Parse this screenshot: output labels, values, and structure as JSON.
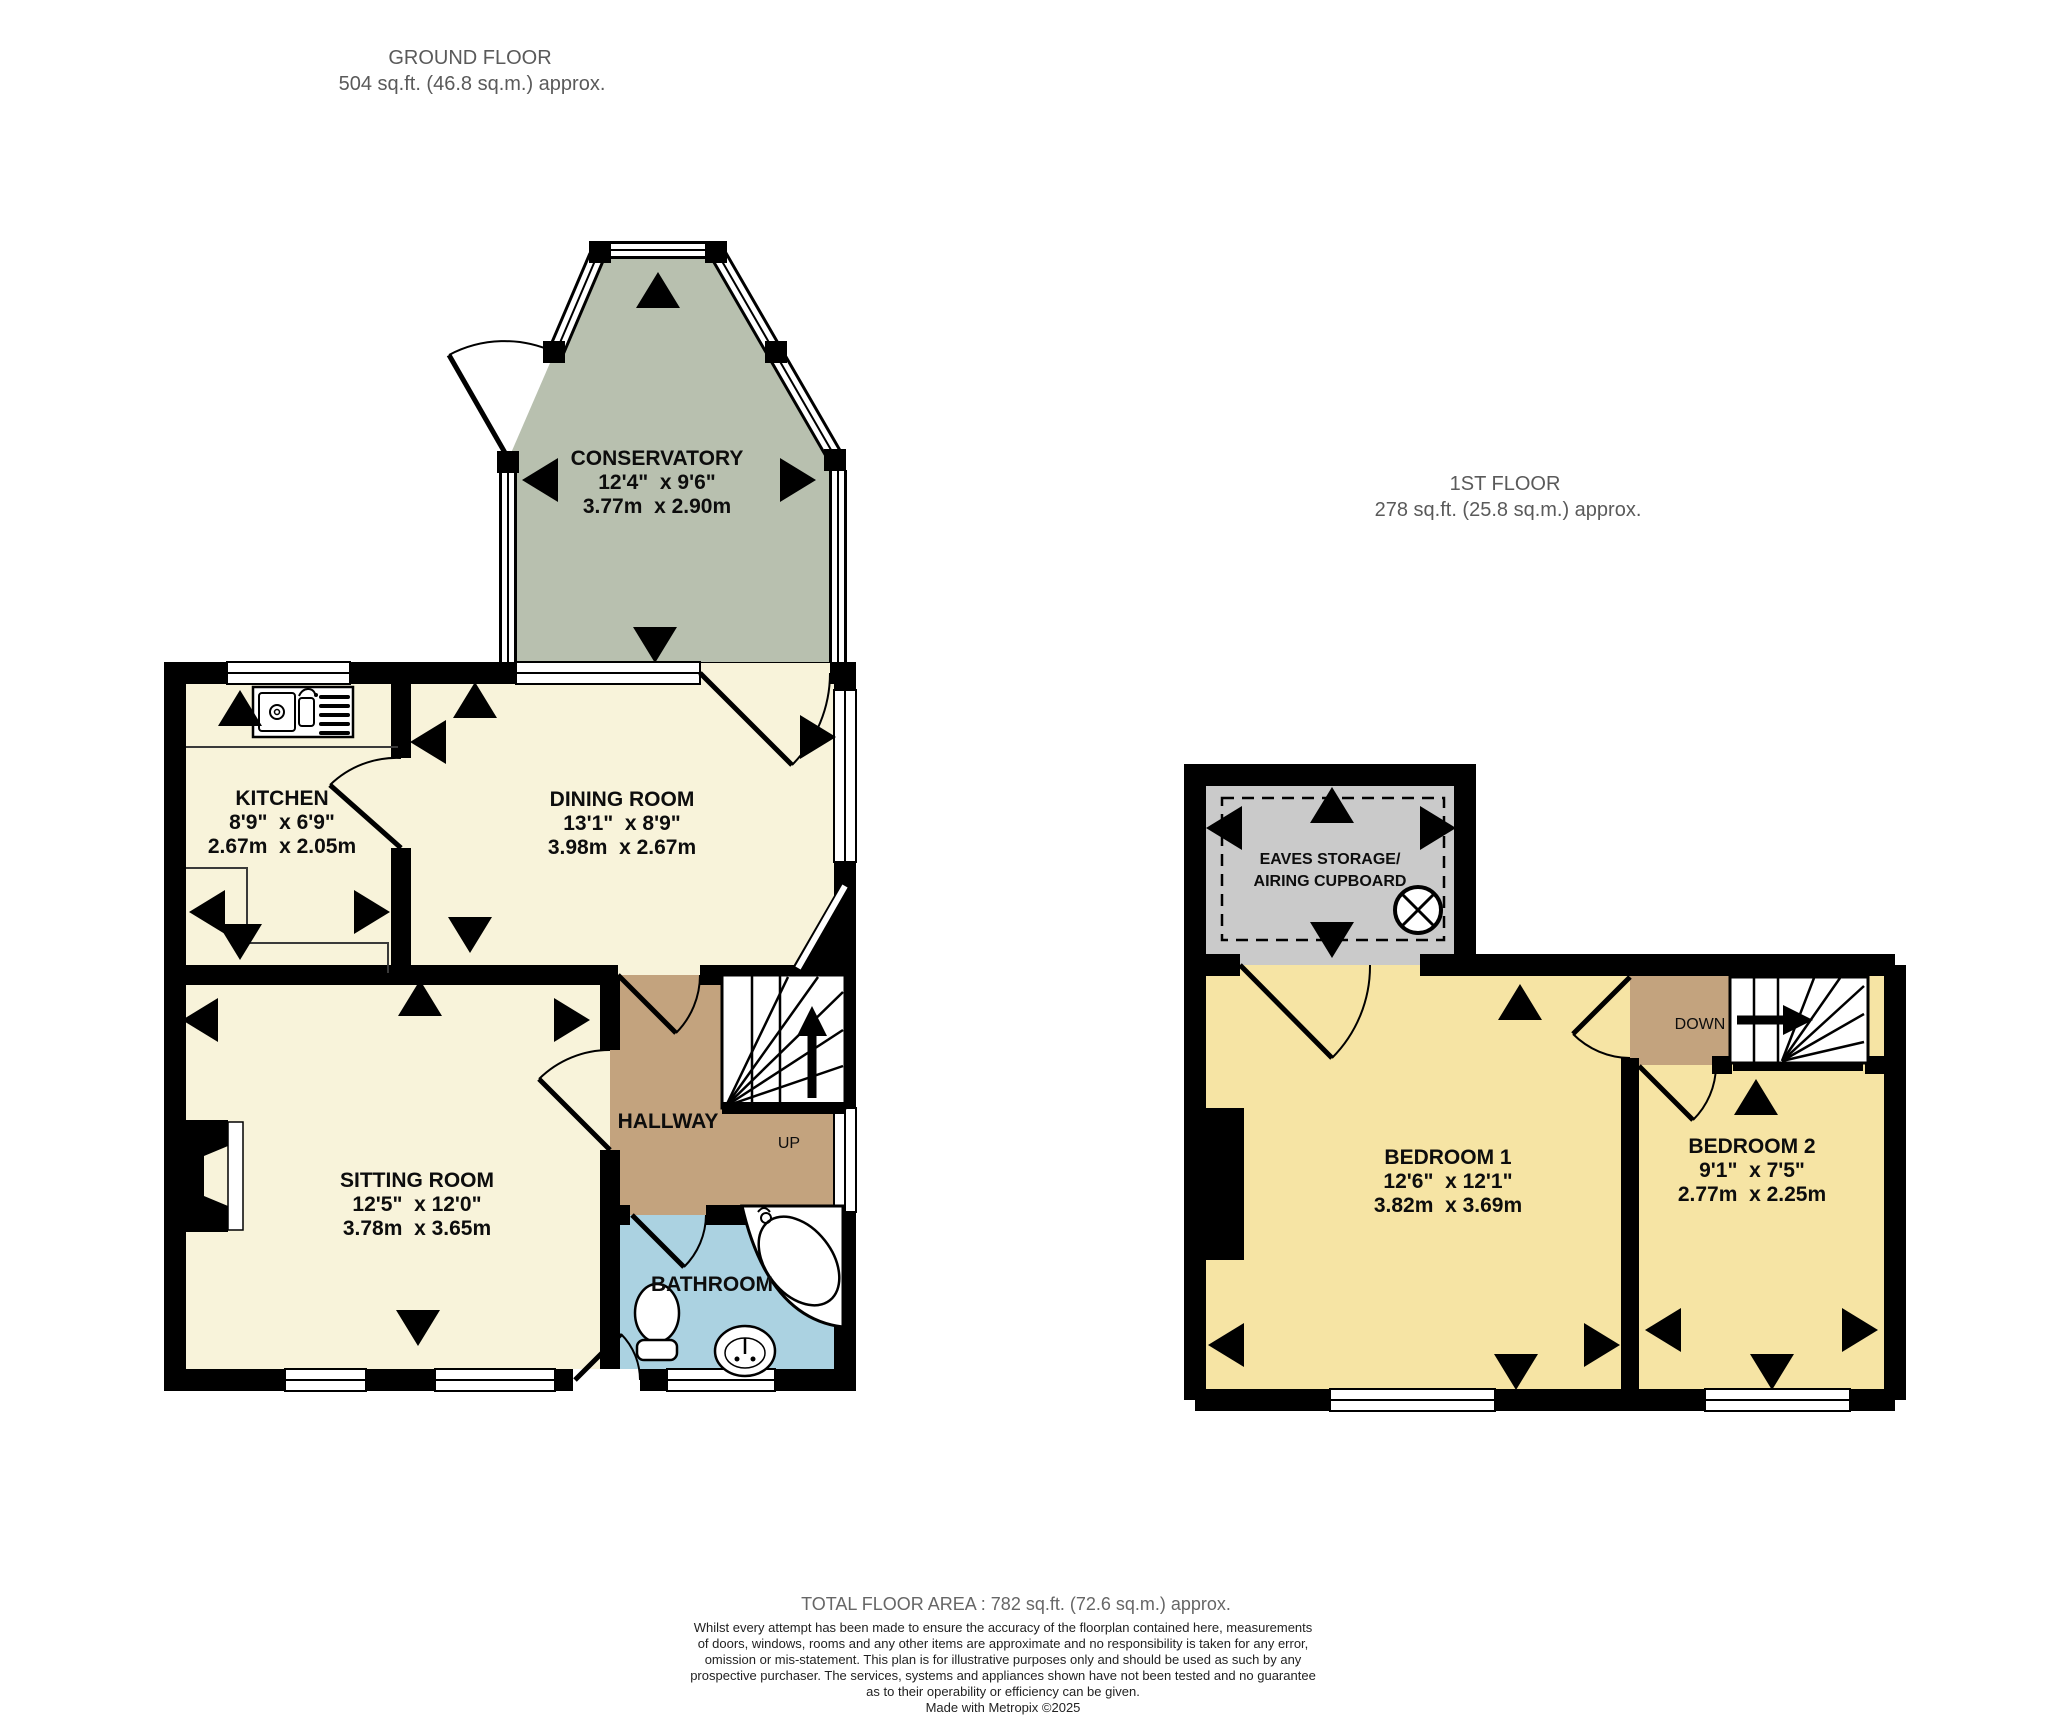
{
  "ground_floor": {
    "title": "GROUND FLOOR",
    "area": "504 sq.ft. (46.8 sq.m.) approx.",
    "up_label": "UP",
    "rooms": {
      "conservatory": {
        "name": "CONSERVATORY",
        "imperial": "12'4\"  x 9'6\"",
        "metric": "3.77m  x 2.90m"
      },
      "kitchen": {
        "name": "KITCHEN",
        "imperial": "8'9\"  x 6'9\"",
        "metric": "2.67m  x 2.05m"
      },
      "dining_room": {
        "name": "DINING ROOM",
        "imperial": "13'1\"  x 8'9\"",
        "metric": "3.98m  x 2.67m"
      },
      "sitting_room": {
        "name": "SITTING ROOM",
        "imperial": "12'5\"  x 12'0\"",
        "metric": "3.78m  x 3.65m"
      },
      "hallway": {
        "name": "HALLWAY"
      },
      "bathroom": {
        "name": "BATHROOM"
      }
    }
  },
  "first_floor": {
    "title": "1ST FLOOR",
    "area": "278 sq.ft. (25.8 sq.m.) approx.",
    "down_label": "DOWN",
    "rooms": {
      "eaves_storage": {
        "line1": "EAVES STORAGE/",
        "line2": "AIRING CUPBOARD"
      },
      "bedroom_1": {
        "name": "BEDROOM 1",
        "imperial": "12'6\"  x 12'1\"",
        "metric": "3.82m  x 3.69m"
      },
      "bedroom_2": {
        "name": "BEDROOM 2",
        "imperial": "9'1\"  x 7'5\"",
        "metric": "2.77m  x 2.25m"
      }
    }
  },
  "footer": {
    "total": "TOTAL FLOOR AREA : 782 sq.ft. (72.6 sq.m.) approx.",
    "disclaimer": [
      "Whilst every attempt has been made to ensure the accuracy of the floorplan contained here, measurements",
      "of doors, windows, rooms and any other items are approximate and no responsibility is taken for any error,",
      "omission or mis-statement. This plan is for illustrative purposes only and should be used as such by any",
      "prospective purchaser. The services, systems and appliances shown have not been tested and no guarantee",
      "as to their operability or efficiency can be given.",
      "Made with Metropix ©2025"
    ]
  },
  "colors": {
    "room_cream": "#f8f3da",
    "room_yellow": "#f6e4a4",
    "hallway_tan": "#c3a37e",
    "bathroom_blue": "#abd2e1",
    "conservatory_green": "#b8c0af",
    "storage_grey": "#cacaca",
    "wall_black": "#000000"
  }
}
